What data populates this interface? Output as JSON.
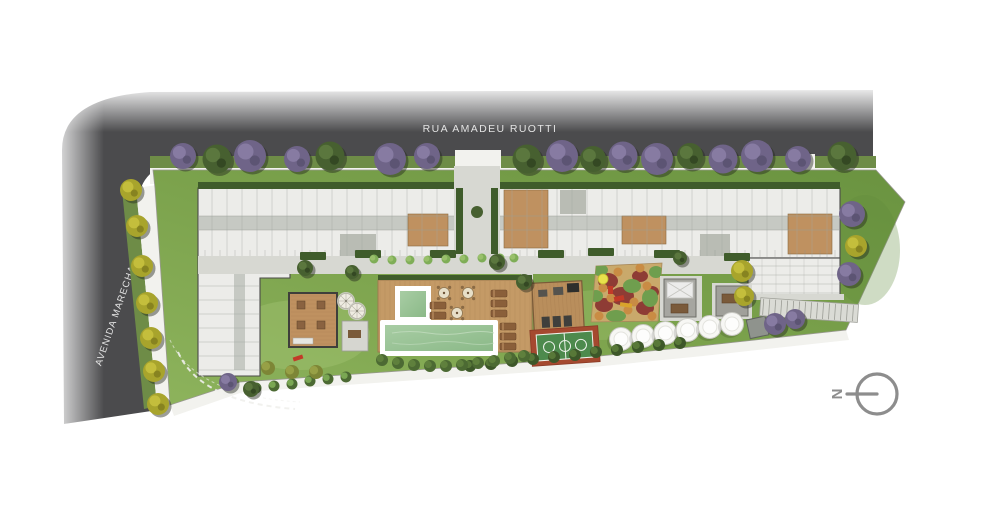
{
  "labels": {
    "street_top": "RUA AMADEU RUOTTI",
    "street_left": "AVENIDA MARECHAL TITO",
    "compass_north": "N"
  },
  "icons": {
    "north_indicator": "circle-with-west-pointing-line"
  },
  "colors": {
    "asphalt": "#4b4b4d",
    "sidewalk": "#f2f2ee",
    "verge": "#6e8c47",
    "lawn_light": "#9cba6b",
    "lawn_mid": "#7fa44f",
    "lawn_dark": "#6a9340",
    "hedge": "#3f5c2b",
    "shrub": "#4c6a33",
    "shrub_light": "#7fae57",
    "building_fill": "#ecece9",
    "building_wall": "#4a4a48",
    "corridor": "#c6c9c3",
    "paving": "#d7d8d2",
    "deck_wood": "#c49a66",
    "interior_wood": "#bf9160",
    "pool_rim": "#ffffff",
    "pool_water": "#9cc69b",
    "pool_water_dark": "#86b383",
    "court_surround": "#a5492f",
    "court_floor": "#4d8a4d",
    "court_lines": "#eef3ec",
    "playground_base": "#c9a96b",
    "playground_red": "#8e3c35",
    "playground_green": "#6f9e4e",
    "playground_orange": "#c98c44",
    "playground_yellow": "#e8e14b",
    "equipment_red": "#c23a28",
    "gazebo": "#a6a6a0",
    "tree_purple": "#6f6488",
    "tree_yellow": "#a8a42c",
    "tree_green": "#476030",
    "street_text": "#e3e3e3",
    "compass": "#8d8d8d"
  }
}
